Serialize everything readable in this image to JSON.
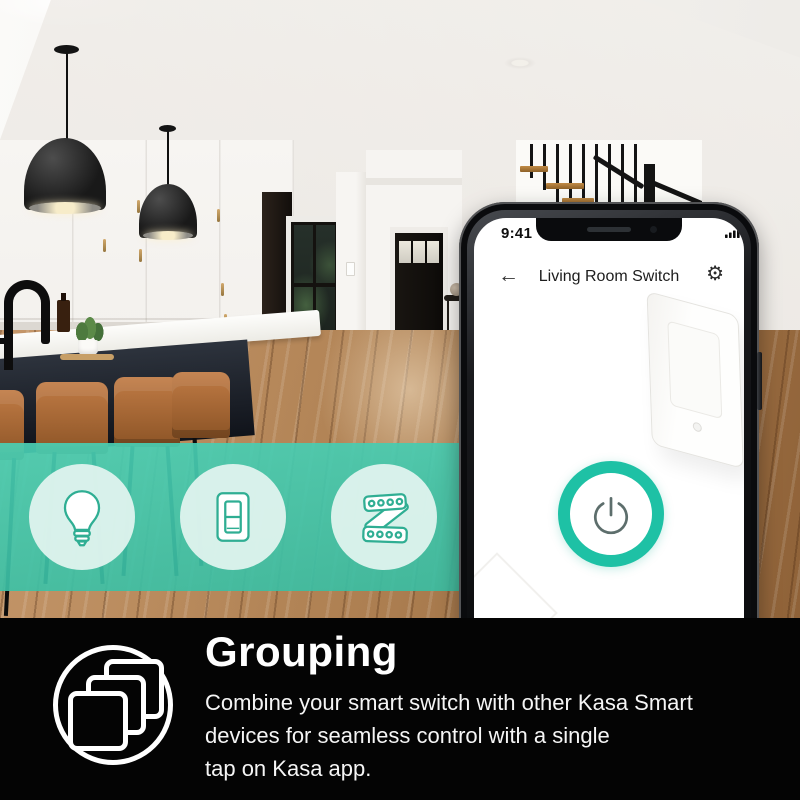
{
  "colors": {
    "accent_teal_band": "#3fc7ac",
    "power_ring_teal": "#1ec1a5",
    "panel_background": "#040404",
    "text_white": "#ffffff"
  },
  "phone": {
    "status_bar": {
      "time": "9:41",
      "icons": [
        "signal-bars",
        "wifi",
        "battery-full"
      ]
    },
    "header": {
      "back_icon": "arrow-left",
      "title": "Living Room Switch",
      "settings_icon": "gear"
    },
    "screen": {
      "device_image": "white-smart-wall-switch",
      "power_button_icon": "power-symbol"
    }
  },
  "feature_band": {
    "icons": [
      {
        "name": "smart-bulb-icon"
      },
      {
        "name": "smart-switch-icon"
      },
      {
        "name": "led-light-strip-icon"
      }
    ]
  },
  "bottom_panel": {
    "icon": "grouping-layered-squares",
    "title": "Grouping",
    "description_lines": [
      "Combine your smart switch with other Kasa Smart",
      "devices for seamless control with a single",
      "tap on Kasa app."
    ]
  }
}
